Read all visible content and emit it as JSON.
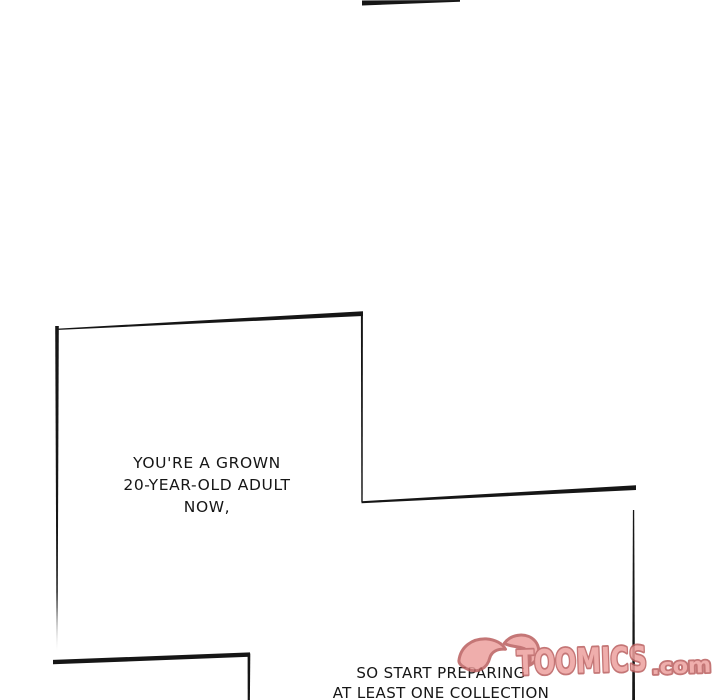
{
  "page": {
    "kind": "webtoon comic page",
    "background_color": "#ffffff",
    "ink_color": "#161616"
  },
  "speech_1": {
    "line_1": "YOU'RE A GROWN",
    "line_2": "20-YEAR-OLD ADULT",
    "line_3": "NOW,"
  },
  "speech_2": {
    "line_1": "SO START PREPARING",
    "line_2": "AT LEAST ONE COLLECTION"
  },
  "watermark": {
    "brand": "TOOMICS",
    "suffix": ".com",
    "fill_color": "#EDA09E",
    "outline_color": "#BA5F5F"
  }
}
